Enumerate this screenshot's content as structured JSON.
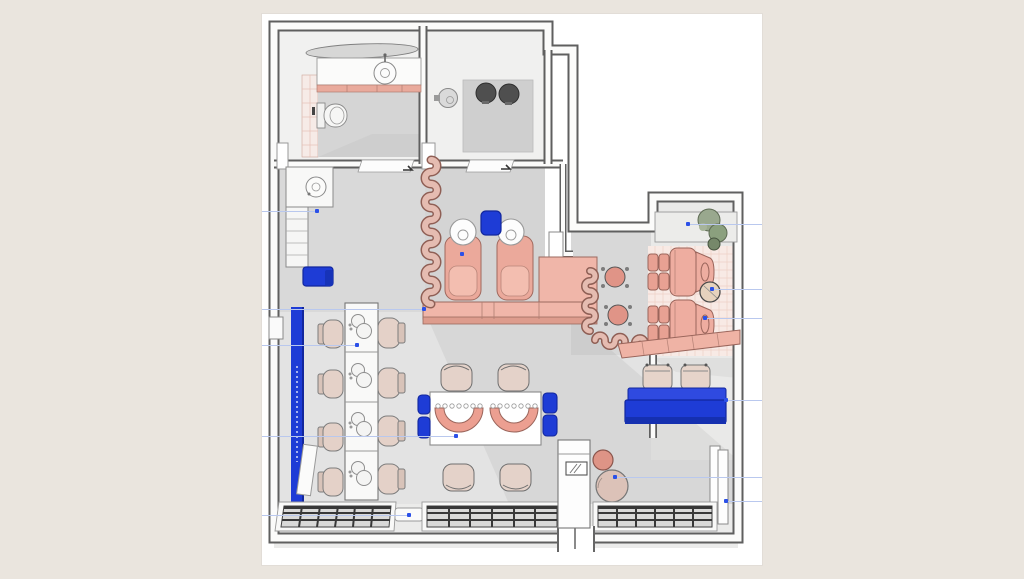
{
  "page": {
    "background_color": "#eae5de"
  },
  "canvas": {
    "left": 262,
    "top": 14,
    "width": 500,
    "height": 551,
    "background_color": "#ffffff"
  },
  "palette": {
    "wall_outline": "#5f5f5f",
    "wall_core": "#fbfbfa",
    "floor_light": "#e3e3e3",
    "floor_mid": "#d6d6d6",
    "accent_blue": "#1e3cd6",
    "accent_blue_dark": "#12279e",
    "salmon": "#eeab9d",
    "salmon_outline": "#9a655b",
    "salmon_light": "#f3beb0",
    "beige_chair": "#e4d1c8",
    "tile_pink": "#f8eae5",
    "tile_pink_line": "#eed0c6",
    "plant_green": "#99a88e",
    "washer_gray": "#4f4f4f",
    "mat_dark": "#383838",
    "marker_blue": "#2b50e8",
    "guide_line_blue": "#b9c8ee"
  },
  "markers": [
    {
      "name": "marker-storage-cabinet",
      "x": 55,
      "y": 197,
      "leader": "left"
    },
    {
      "name": "marker-wash-station",
      "x": 200,
      "y": 240,
      "leader": "none"
    },
    {
      "name": "marker-lounge-shelf",
      "x": 426,
      "y": 210,
      "leader": "right"
    },
    {
      "name": "marker-side-table",
      "x": 450,
      "y": 275,
      "leader": "right"
    },
    {
      "name": "marker-pedicure-chair",
      "x": 443,
      "y": 304,
      "leader": "right"
    },
    {
      "name": "marker-manicure-bar",
      "x": 95,
      "y": 331,
      "leader": "left"
    },
    {
      "name": "marker-reception-counter",
      "x": 162,
      "y": 295,
      "leader": "left"
    },
    {
      "name": "marker-nail-table",
      "x": 194,
      "y": 422,
      "leader": "left"
    },
    {
      "name": "marker-blue-sofa",
      "x": 464,
      "y": 386,
      "leader": "right"
    },
    {
      "name": "marker-pouf",
      "x": 353,
      "y": 463,
      "leader": "right"
    },
    {
      "name": "marker-door-panel",
      "x": 464,
      "y": 487,
      "leader": "right"
    },
    {
      "name": "marker-entrance-mat",
      "x": 147,
      "y": 501,
      "leader": "left"
    }
  ]
}
